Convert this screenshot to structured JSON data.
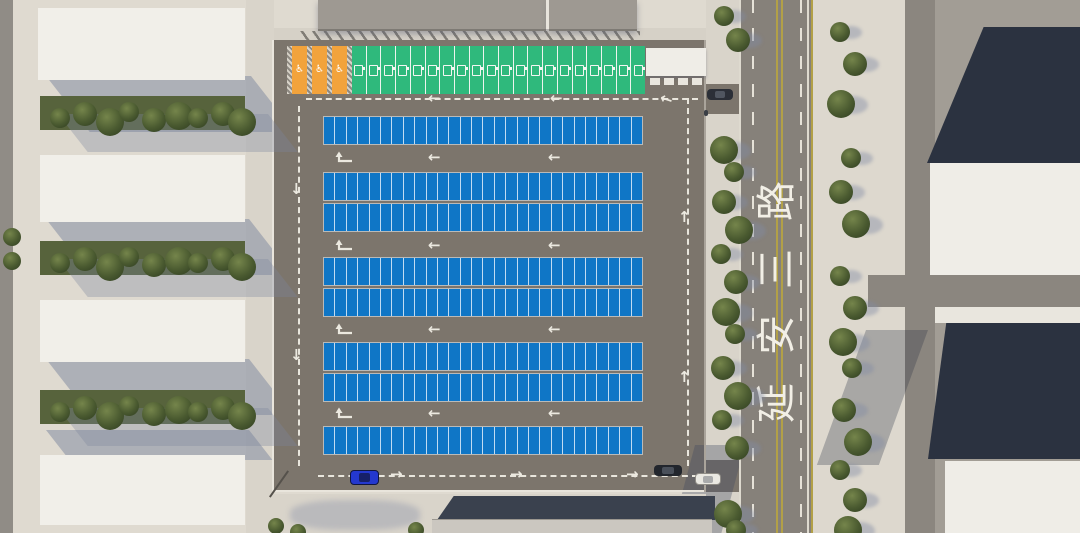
{
  "scene": {
    "view": "top-down aerial 3D render",
    "subject": "Surface parking lot site plan beside urban road"
  },
  "road": {
    "name": "延安三路",
    "name_chars": [
      "路",
      "三",
      "安",
      "延"
    ],
    "marking_colors": {
      "lane_line": "#e6e2d8",
      "center_line": "#b2a047",
      "edge_line": "#dedacf"
    }
  },
  "parking_lot": {
    "asphalt_color": "#7c756c",
    "marking_color": "#e9e6dd",
    "standard_stalls": {
      "color": "#0f76c6",
      "row_count": 8,
      "stalls_per_row": 28,
      "total": 224
    },
    "ev_stalls": {
      "count": 20,
      "color": "#2fb97c",
      "icon": "ev-charger-icon"
    },
    "accessible_stalls": {
      "count": 3,
      "color": "#f2a33c",
      "icon": "wheelchair-icon",
      "symbol": "♿"
    },
    "circulation": {
      "perimeter": "dashed loop",
      "top_arrows": "left",
      "right_arrows": "up",
      "bottom_arrows": "right",
      "left_arrows": "down",
      "aisle_arrows": "left"
    }
  },
  "vehicles": [
    {
      "id": "blue-car",
      "color": "#2438cf"
    },
    {
      "id": "dark-car-parking-exit",
      "color": "#22262d"
    },
    {
      "id": "dark-car-east-entrance",
      "color": "#2b2f37"
    },
    {
      "id": "white-car-south-driveway",
      "color": "#eae8e2"
    }
  ],
  "environment": {
    "tree_color": "#4a5a30",
    "sidewalk_color": "#d9d4ca",
    "building_color": "#f1efe9",
    "dark_roof_color": "#2b3240",
    "shadow_color": "#8a93aa",
    "ground_left": "#dfdad0",
    "ground_right": "#a29d95",
    "road_color": "#86817a"
  }
}
